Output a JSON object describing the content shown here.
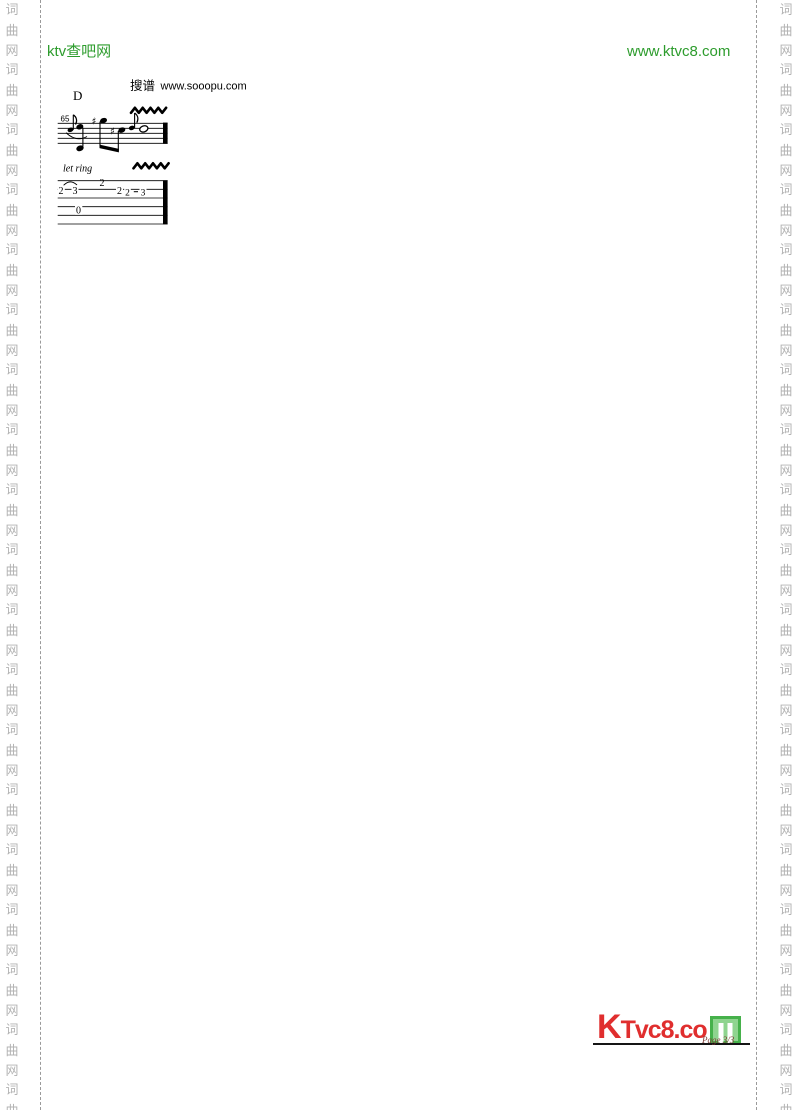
{
  "header": {
    "site_name": "ktv查吧网",
    "site_url": "www.ktvc8.com",
    "accent_color": "#2d9c2d"
  },
  "watermark": {
    "chars": [
      "词",
      "曲",
      "网"
    ],
    "repeat": 19,
    "color": "#b3b3b3"
  },
  "score": {
    "search_label": "搜谱",
    "search_url": "www.sooopu.com",
    "chord": "D",
    "measure_number": "65",
    "expression": "let ring",
    "sharp_symbol": "♯",
    "tab_numbers": [
      "2",
      "3",
      "2",
      "2",
      "2",
      "3",
      "0"
    ]
  },
  "footer": {
    "logo_text": "KTvc8.co",
    "logo_m": "M",
    "page_label": "Page 3/3",
    "logo_red": "#e02e2e",
    "logo_green": "#46b14b"
  }
}
